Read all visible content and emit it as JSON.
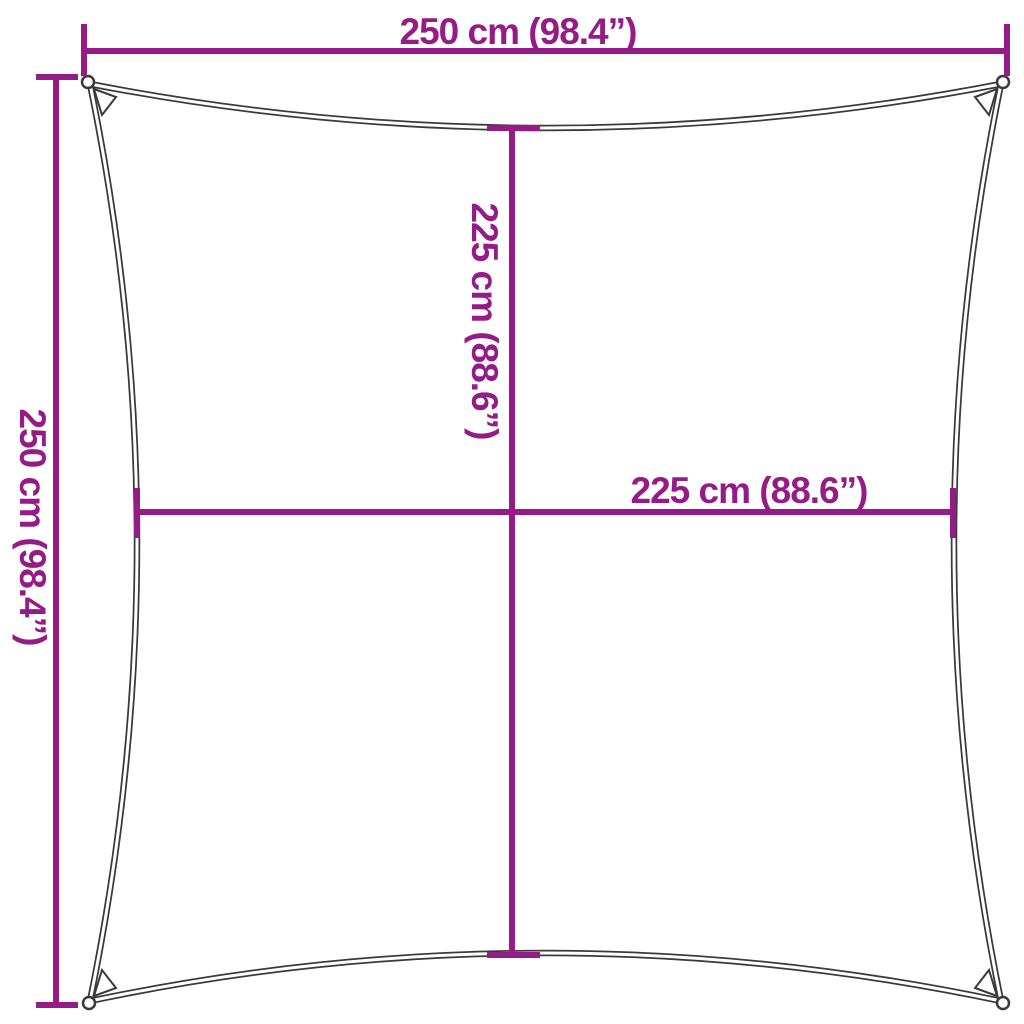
{
  "colors": {
    "accent": "#951B87",
    "outline": "#3A3A3A",
    "background": "#FFFFFF"
  },
  "diagram": {
    "shape": "square-shade-sail",
    "dimensions": {
      "top": {
        "label": "250 cm (98.4”)",
        "value_cm": 250,
        "value_in": 98.4,
        "orientation": "horizontal"
      },
      "left": {
        "label": "250 cm (98.4”)",
        "value_cm": 250,
        "value_in": 98.4,
        "orientation": "vertical"
      },
      "center_vertical": {
        "label": "225 cm (88.6”)",
        "value_cm": 225,
        "value_in": 88.6,
        "orientation": "vertical"
      },
      "center_horizontal": {
        "label": "225 cm (88.6”)",
        "value_cm": 225,
        "value_in": 88.6,
        "orientation": "horizontal"
      }
    }
  }
}
